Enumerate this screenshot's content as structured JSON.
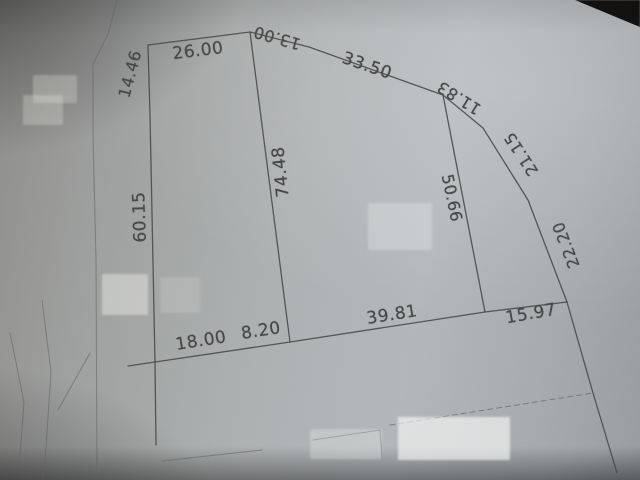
{
  "colors": {
    "paper_mid": "#aeb1b2",
    "paper_shadow": "#6f6f6d",
    "background_dark": "#0e0d0b",
    "ink": "#4a4a48"
  },
  "diagram": {
    "dimension_labels": [
      {
        "text": "26.00",
        "x": 198,
        "y": 51,
        "rot": -7,
        "size": 17
      },
      {
        "text": "13.00",
        "x": 277,
        "y": 38,
        "rot": 196,
        "size": 16
      },
      {
        "text": "33.50",
        "x": 367,
        "y": 66,
        "rot": 19,
        "size": 17
      },
      {
        "text": "11.83",
        "x": 459,
        "y": 98,
        "rot": 212,
        "size": 16
      },
      {
        "text": "21.15",
        "x": 521,
        "y": 154,
        "rot": 237,
        "size": 16
      },
      {
        "text": "22.20",
        "x": 566,
        "y": 245,
        "rot": 249,
        "size": 16
      },
      {
        "text": "14.46",
        "x": 130,
        "y": 74,
        "rot": -75,
        "size": 16
      },
      {
        "text": "60.15",
        "x": 140,
        "y": 217,
        "rot": -92,
        "size": 17
      },
      {
        "text": "74.48",
        "x": 281,
        "y": 172,
        "rot": -96,
        "size": 17
      },
      {
        "text": "50.66",
        "x": 452,
        "y": 198,
        "rot": 78,
        "size": 16
      },
      {
        "text": "18.00",
        "x": 201,
        "y": 341,
        "rot": -9,
        "size": 17
      },
      {
        "text": "8.20",
        "x": 261,
        "y": 331,
        "rot": -9,
        "size": 17
      },
      {
        "text": "39.81",
        "x": 392,
        "y": 315,
        "rot": -9,
        "size": 17
      },
      {
        "text": "15.97",
        "x": 531,
        "y": 314,
        "rot": -10,
        "size": 17
      }
    ],
    "parcel_lines": [
      {
        "name": "edge-top-26",
        "points": "148,45 250,32"
      },
      {
        "name": "edge-top-13-and-33-50",
        "points": "250,32 309,47 443,95"
      },
      {
        "name": "edge-right-11-21-22",
        "points": "443,95 483,128 528,200 567,302"
      },
      {
        "name": "edge-bottom",
        "points": "128,366 155,362 290,342 485,312 567,302"
      },
      {
        "name": "edge-left",
        "points": "148,45 150,115 155,362 156,445"
      },
      {
        "name": "interior-line-74-48",
        "points": "250,32 290,342"
      },
      {
        "name": "interior-line-50-66",
        "points": "443,95 485,312"
      },
      {
        "name": "right-boundary-extension",
        "points": "567,302 593,393 617,473"
      }
    ],
    "faint_lines": [
      {
        "name": "road-line-left",
        "points": "117,0 108,34 93,64 93,136 96,260 97,477"
      },
      {
        "name": "curve-line-a",
        "points": "42,300 51,372 46,448 43,480"
      },
      {
        "name": "curve-line-b",
        "points": "10,333 24,402 19,468"
      },
      {
        "name": "branch-line",
        "points": "90,353 58,410"
      },
      {
        "name": "lot-line-a",
        "points": "162,461 262,450"
      },
      {
        "name": "lot-line-b",
        "points": "313,440 380,430 382,458"
      }
    ],
    "dashed_lines": [
      {
        "name": "lot-line-dashed",
        "points": "390,425 593,393"
      }
    ],
    "patches": [
      {
        "name": "blur-patch-topleft-a",
        "x": 33,
        "y": 75,
        "w": 44,
        "h": 28,
        "tone": "rgba(228,228,222,0.30)"
      },
      {
        "name": "blur-patch-topleft-b",
        "x": 23,
        "y": 95,
        "w": 40,
        "h": 30,
        "tone": "rgba(228,228,222,0.30)"
      },
      {
        "name": "blur-patch-midleft-a",
        "x": 102,
        "y": 274,
        "w": 46,
        "h": 41,
        "tone": "rgba(250,250,244,0.40)"
      },
      {
        "name": "blur-patch-midleft-b",
        "x": 160,
        "y": 277,
        "w": 40,
        "h": 36,
        "tone": "rgba(250,250,244,0.15)"
      },
      {
        "name": "blur-patch-center",
        "x": 368,
        "y": 203,
        "w": 64,
        "h": 47,
        "tone": "rgba(252,254,255,0.26)"
      },
      {
        "name": "blur-patch-bottom-a",
        "x": 310,
        "y": 429,
        "w": 72,
        "h": 30,
        "tone": "rgba(245,247,246,0.28)"
      },
      {
        "name": "blur-patch-bottom-b",
        "x": 398,
        "y": 417,
        "w": 112,
        "h": 43,
        "tone": "rgba(255,255,253,0.60)"
      }
    ]
  }
}
